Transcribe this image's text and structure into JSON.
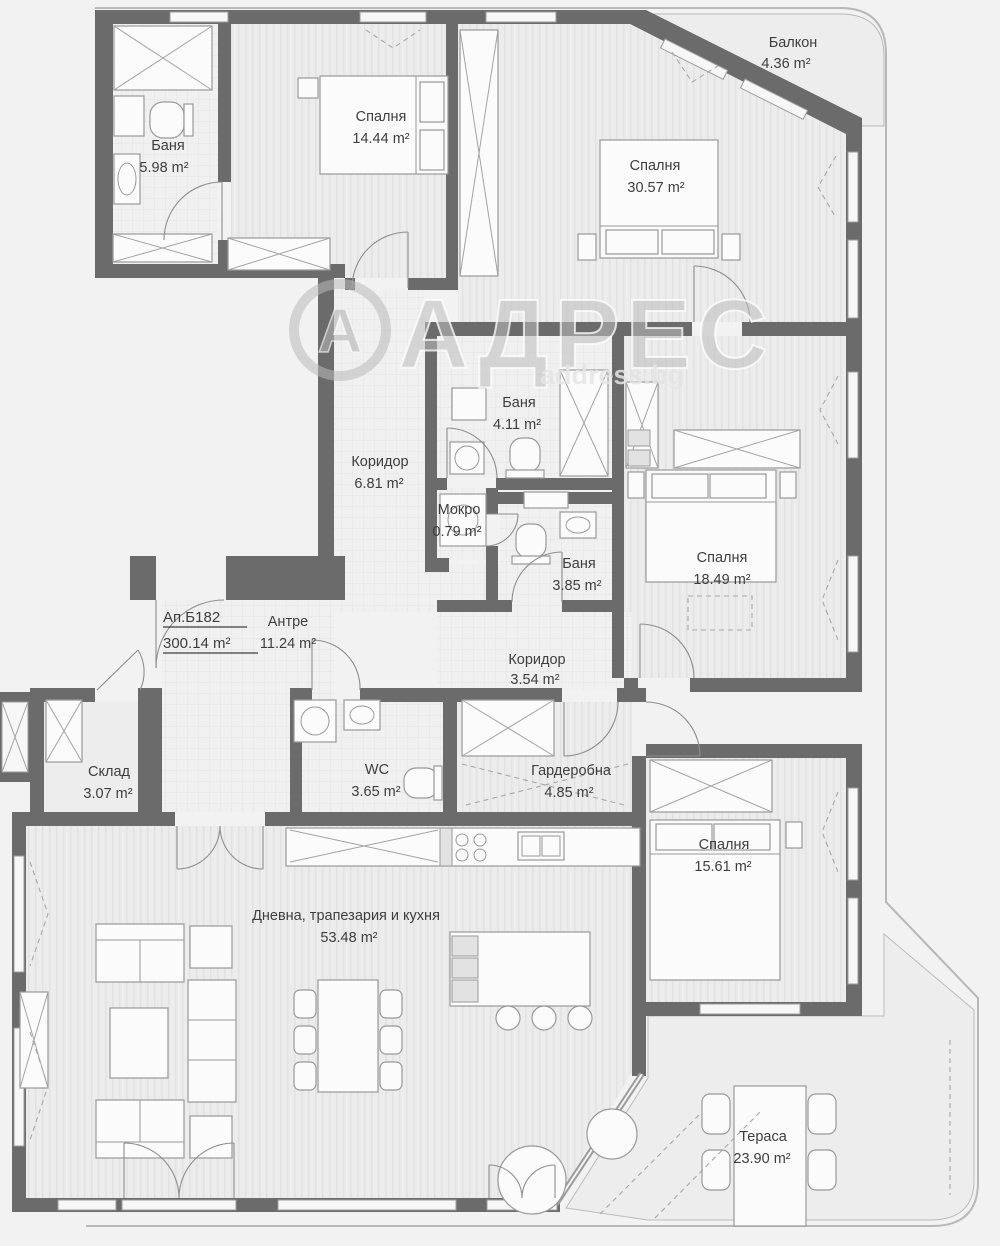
{
  "watermark": {
    "logo_letter": "А",
    "brand": "АДРЕС",
    "site": "address.bg"
  },
  "apartment": {
    "label": "Ап.Б182",
    "total_area": "300.14 m²"
  },
  "rooms": [
    {
      "name": "Балкон",
      "area": "4.36 m²"
    },
    {
      "name": "Спалня",
      "area": "14.44 m²"
    },
    {
      "name": "Спалня",
      "area": "30.57 m²"
    },
    {
      "name": "Баня",
      "area": "5.98 m²"
    },
    {
      "name": "Коридор",
      "area": "6.81 m²"
    },
    {
      "name": "Баня",
      "area": "4.11 m²"
    },
    {
      "name": "Мокро",
      "area": "0.79 m²"
    },
    {
      "name": "Баня",
      "area": "3.85 m²"
    },
    {
      "name": "Спалня",
      "area": "18.49 m²"
    },
    {
      "name": "Антре",
      "area": "11.24 m²"
    },
    {
      "name": "Коридор",
      "area": "3.54 m²"
    },
    {
      "name": "Склад",
      "area": "3.07 m²"
    },
    {
      "name": "WC",
      "area": "3.65 m²"
    },
    {
      "name": "Гардеробна",
      "area": "4.85 m²"
    },
    {
      "name": "Спалня",
      "area": "15.61 m²"
    },
    {
      "name": "Дневна, трапезария и кухня",
      "area": "53.48 m²"
    },
    {
      "name": "Тераса",
      "area": "23.90 m²"
    }
  ]
}
